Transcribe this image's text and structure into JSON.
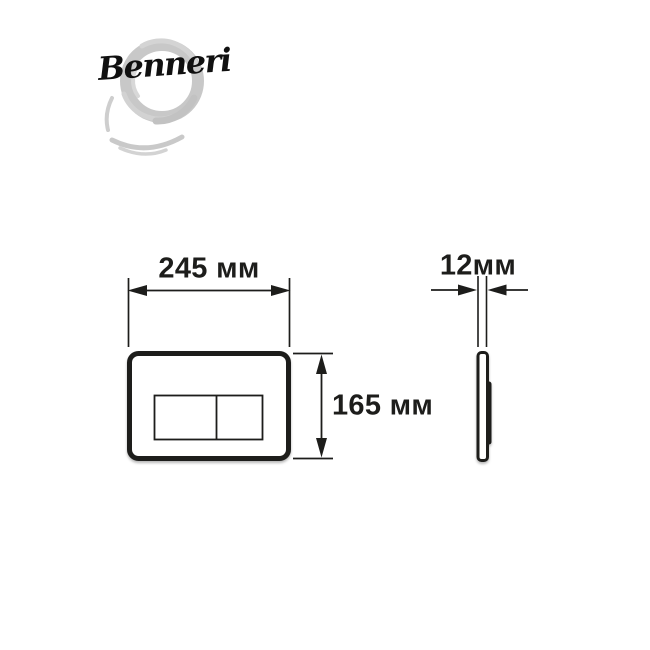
{
  "brand": {
    "name": "Benneri"
  },
  "dimensions": {
    "width_label": "245 мм",
    "height_label": "165 мм",
    "depth_label": "12мм"
  },
  "colors": {
    "line": "#1d1d1b",
    "text": "#1d1d1b",
    "background": "#ffffff",
    "brush_gray": "#c8c8c8"
  },
  "icons": {
    "brand_mark": "enso-brush-circle-icon"
  }
}
